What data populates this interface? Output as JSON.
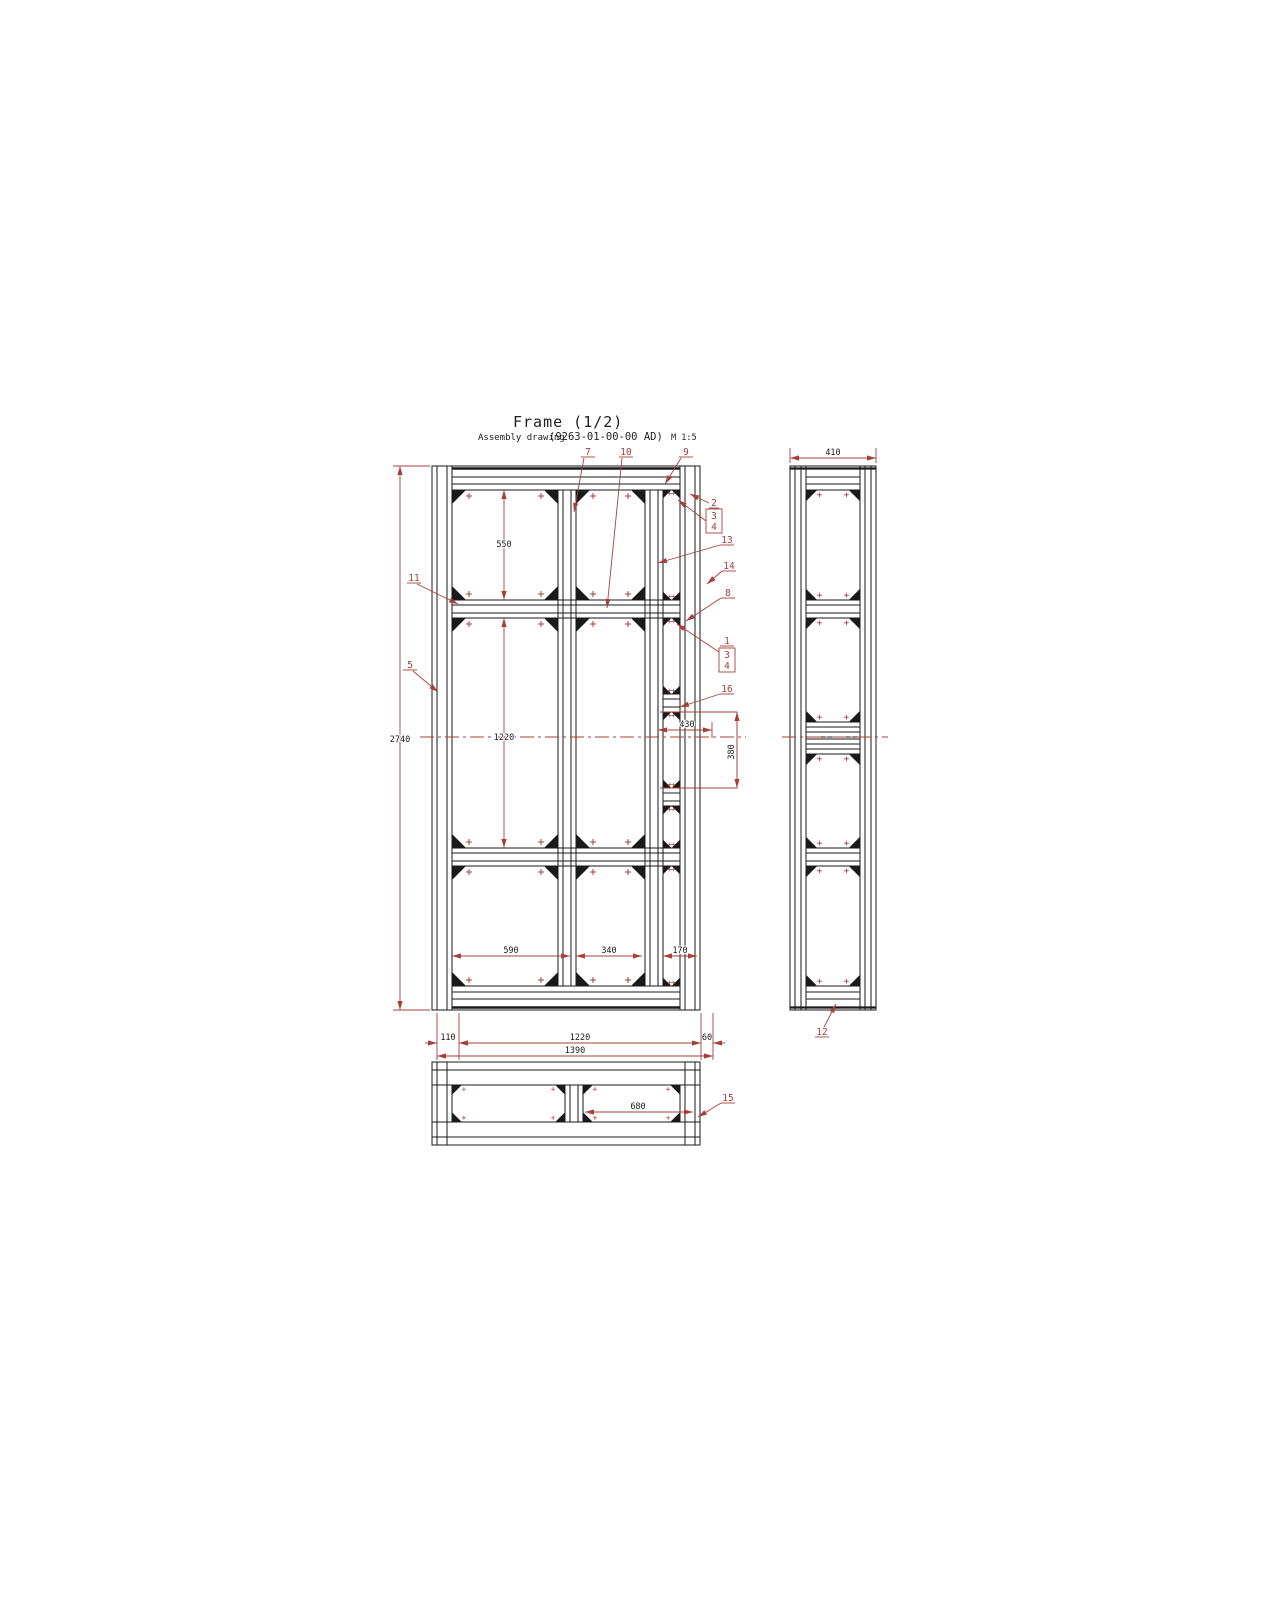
{
  "drawing": {
    "title": "Frame (1/2)",
    "subtitle_label": "Assembly drawing",
    "subtitle_code": "(9263-01-00-00 AD)",
    "subtitle_scale": "M 1:5"
  },
  "colors": {
    "geometry": "#1a1a1a",
    "annotation": "#a6403a",
    "background": "#ffffff"
  },
  "front_view": {
    "dims": {
      "overall_height": "2740",
      "top_bay_height": "550",
      "middle_bay_height": "1220",
      "bay_width_left": "590",
      "bay_width_middle": "340",
      "bay_width_right": "170",
      "offset_left": "110",
      "inner_width": "1220",
      "offset_right": "60",
      "overall_width": "1390",
      "opening_width": "430",
      "opening_height": "380"
    },
    "callouts": {
      "c7": "7",
      "c10": "10",
      "c9": "9",
      "c2": "2",
      "c3a": "3",
      "c4a": "4",
      "c13": "13",
      "c14": "14",
      "c8": "8",
      "c1": "1",
      "c3b": "3",
      "c4b": "4",
      "c16": "16",
      "c11": "11",
      "c5": "5"
    }
  },
  "side_view": {
    "dims": {
      "overall_depth": "410"
    },
    "callouts": {
      "c12": "12"
    }
  },
  "bottom_view": {
    "dims": {
      "bay_width": "680"
    },
    "callouts": {
      "c15": "15"
    }
  }
}
